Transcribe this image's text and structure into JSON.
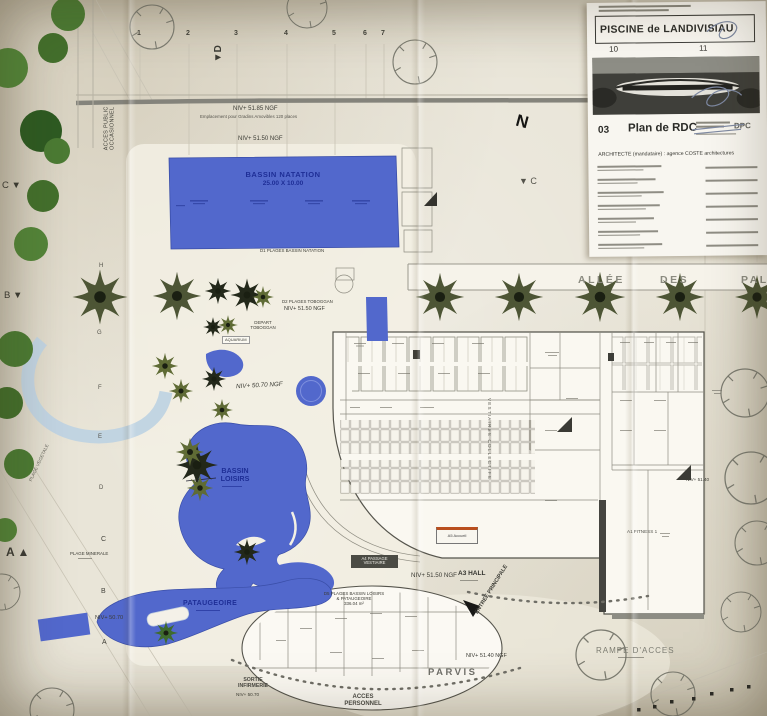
{
  "title_block": {
    "project_title": "PISCINE de LANDIVISIAU",
    "sheet_numbers": {
      "left": "10",
      "right": "11"
    },
    "drawing_index": "03",
    "drawing_title": "Plan de RDC",
    "stamp": "DPC",
    "architect_line": "ARCHITECTE (mandataire) : agence COSTE architectures"
  },
  "pools": {
    "natation": {
      "name": "BASSIN NATATION",
      "dimensions": "25.00 X 10.00"
    },
    "loisirs": {
      "name_line1": "BASSIN",
      "name_line2": "LOISIRS"
    },
    "pataugeoire": {
      "name": "PATAUGEOIRE"
    }
  },
  "levels": {
    "niv_5185": "NIV+ 51.85 NGF",
    "niv_5150_natation": "NIV+ 51.50 NGF",
    "niv_5150_toboggan": "NIV+ 51.50 NGF",
    "niv_5070_ngf": "NIV+ 50.70 NGF",
    "niv_5150_hall": "NIV+ 51.50 NGF",
    "niv_5140_ngf": "NIV+ 51.40 NGF",
    "niv_5140": "NIV+ 51.40",
    "niv_5070_sortie": "NIV+ 50.70",
    "niv_5070_plage": "NIV+ 50.70"
  },
  "areas": {
    "gradins": "Emplacement pour Gradins Amovibles 120 places",
    "d1": "D1 PLAGES BASSIN NATATION",
    "d2": "D2 PLAGES TOBOGGAN",
    "d5_line1": "D5 PLAGES BASSIN LOISIRS",
    "d5_line2": "& PATAUGEOIRE",
    "d5_area": "336.04 m²",
    "plage_minerale": "PLAGE MINERALE",
    "plage_vegetale": "PLAGE VEGETALE",
    "depart_toboggan_l1": "DEPART",
    "depart_toboggan_l2": "TOBOGGAN",
    "aquarium": "AQUARIUM"
  },
  "rooms": {
    "a3_hall": "A3 HALL",
    "a4_line1": "A4 PASSAGE",
    "a4_line2": "VESTIAIRE",
    "a5_accueil": "A5 Accueil",
    "a1_fitness": "A1 FITNESS 1",
    "vestiaires_collectifs": "VESTIAIRES COLLECTIFS"
  },
  "access": {
    "entree_principale": "ENTREE PRINCIPALE",
    "parvis": "PARVIS",
    "acces_personnel_l1": "ACCES",
    "acces_personnel_l2": "PERSONNEL",
    "sortie_infirmerie_l1": "SORTIE",
    "sortie_infirmerie_l2": "INFIRMERIE",
    "rampe_acces": "RAMPE D'ACCES",
    "acces_public_l1": "ACCES PUBLIC",
    "acces_public_l2": "OCCASIONNEL",
    "allee_word1": "ALLÉE",
    "allee_word2": "DES",
    "allee_word3": "PAL"
  },
  "markers": {
    "north": "N",
    "section_d": "▼D",
    "section_c_right": "▼ C",
    "section_c_left": "C ▼",
    "section_b_left": "B ▼",
    "section_a_left": "A ▲",
    "grid_top": [
      "1",
      "2",
      "3",
      "4",
      "5",
      "6",
      "7"
    ],
    "grid_letters": [
      "H",
      "G",
      "F",
      "E",
      "D",
      "C",
      "B",
      "A"
    ]
  }
}
